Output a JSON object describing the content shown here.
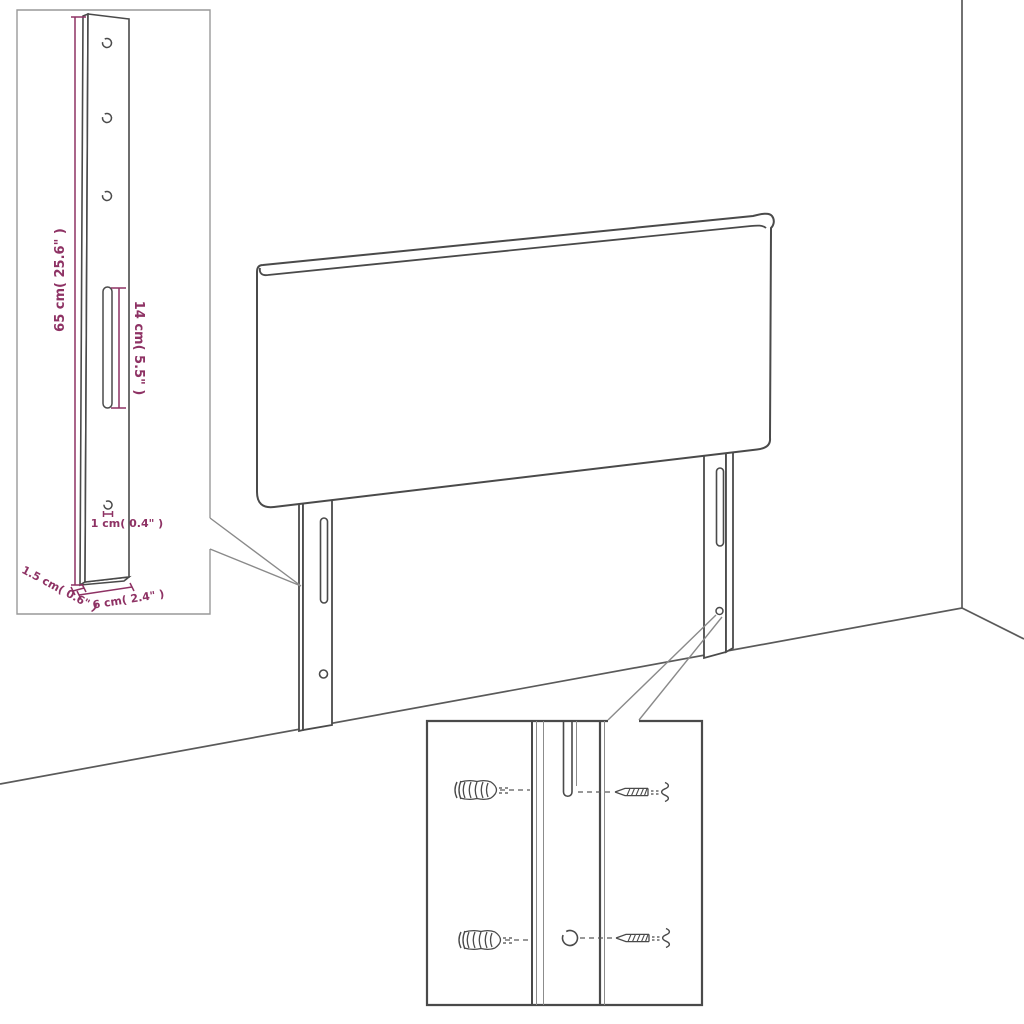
{
  "diagram": {
    "type": "furniture-dimension-diagram",
    "subject": "headboard with mounting legs, wall corner scene",
    "bracket_detail_inset": {
      "height_label": "65 cm( 25.6\" )",
      "slot_label": "14 cm( 5.5\" )",
      "hole_label": "1 cm( 0.4\" )",
      "thickness_label": "1.5 cm( 0.6\" )",
      "width_label": "6 cm( 2.4\" )"
    },
    "hardware_detail_inset": {
      "contents": [
        "wall-anchor x2",
        "screw x2",
        "leg slot",
        "leg hole"
      ]
    },
    "colors": {
      "dimension_text": "#8e3264",
      "drawing_line": "#4a4a4a",
      "callout_line": "#8a8a8a",
      "inset_border_light": "#999999",
      "floor_line": "#5a5a5a"
    }
  }
}
